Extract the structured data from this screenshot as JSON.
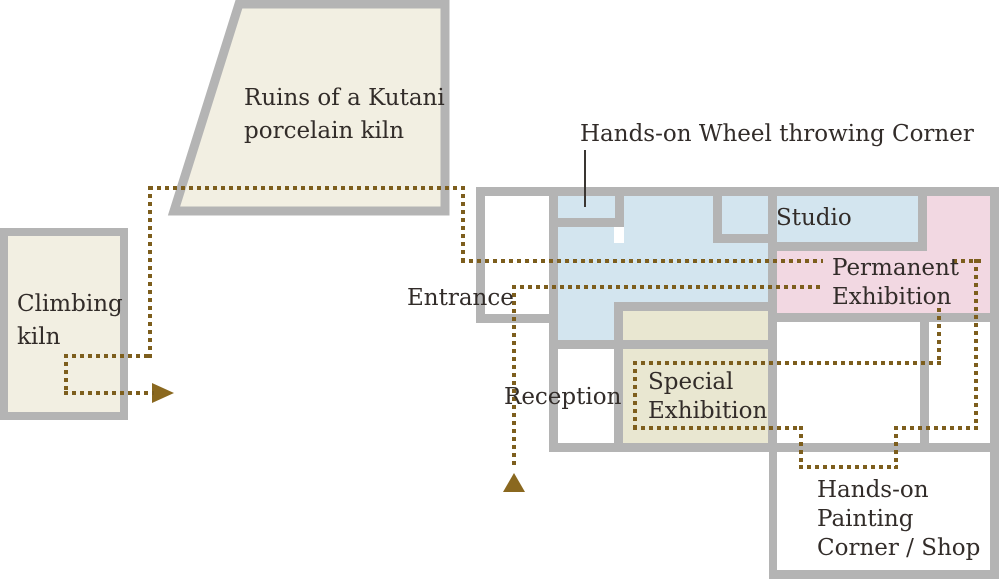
{
  "colors": {
    "wall": "#b4b4b4",
    "blue": "#d3e5ef",
    "pink": "#f2d8e2",
    "olive": "#e9e7d1",
    "beige": "#f2efe2",
    "path": "#7d5e1d",
    "arrow": "#8a681f",
    "ink": "#322c29"
  },
  "labels": {
    "ruins": "Ruins of a Kutani\nporcelain kiln",
    "climbing_kiln": "Climbing\nkiln",
    "wheel_corner": "Hands-on Wheel throwing Corner",
    "studio": "Studio",
    "permanent": "Permanent\nExhibition",
    "entrance": "Entrance",
    "reception": "Reception",
    "special": "Special\nExhibition",
    "shop": "Hands-on\nPainting\nCorner / Shop"
  },
  "icons": {
    "route_arrow_right": "right-pointing route arrow",
    "route_arrow_up": "up-pointing route arrow"
  }
}
